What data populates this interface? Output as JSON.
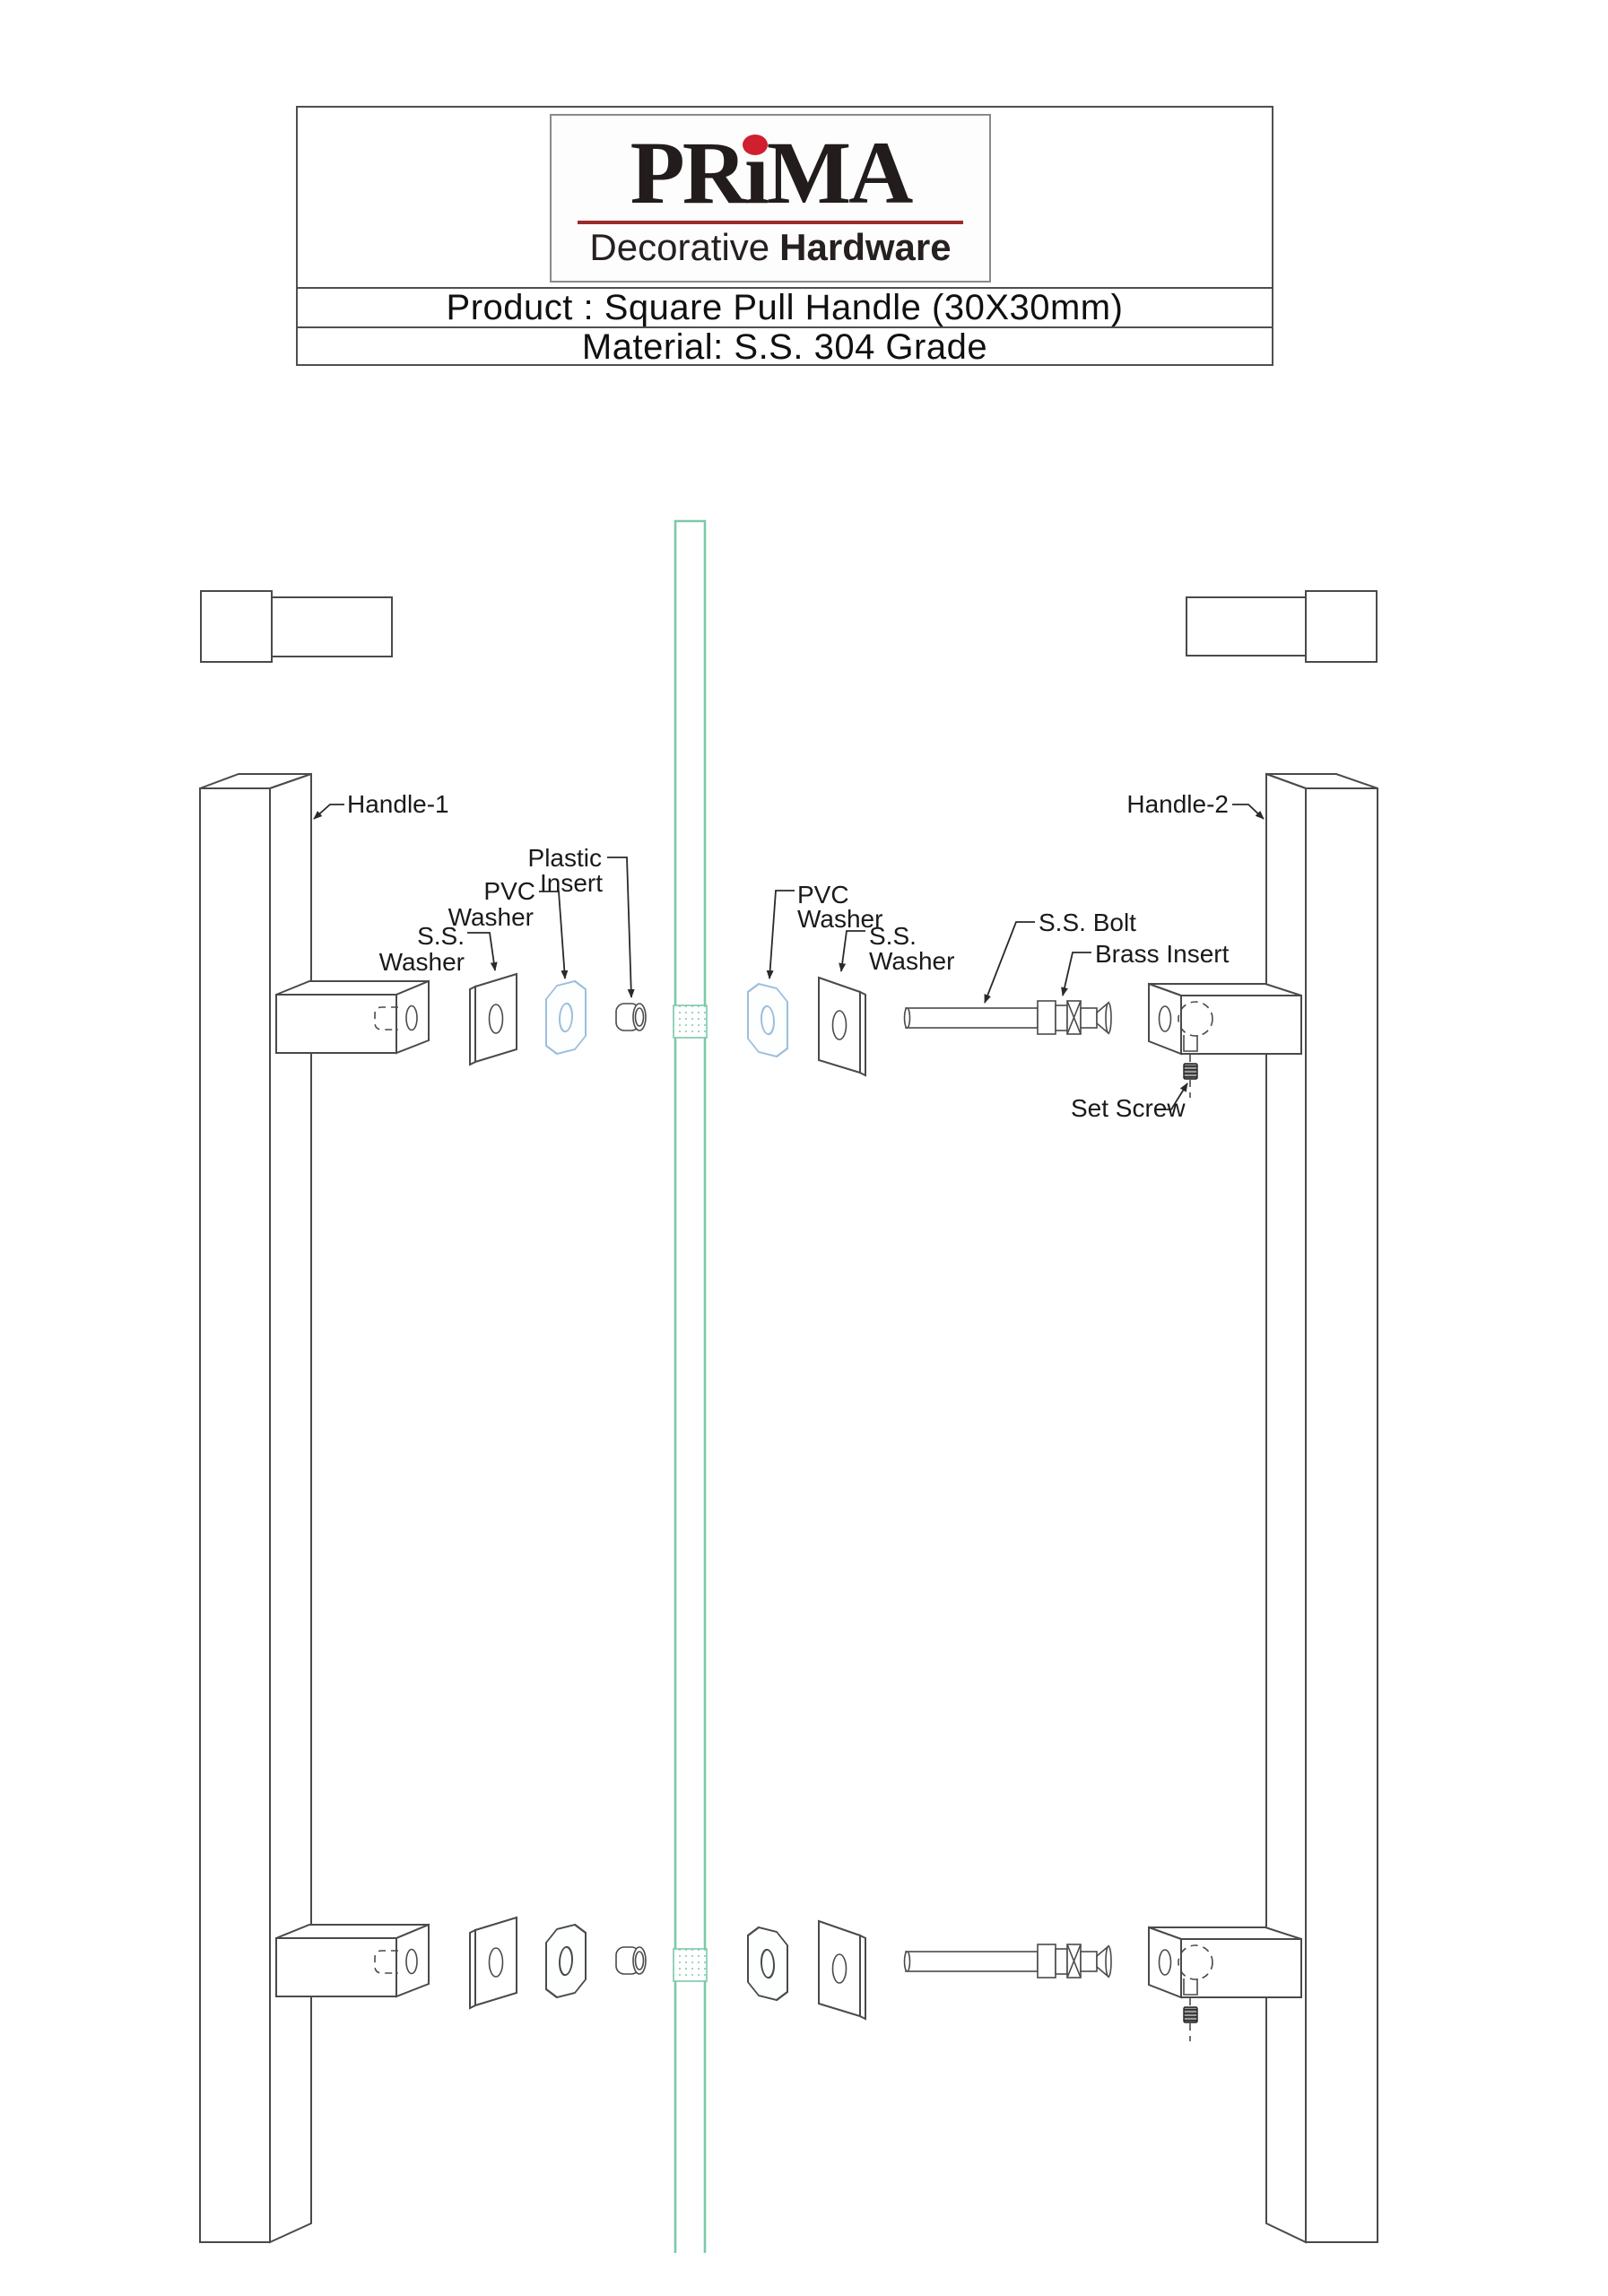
{
  "header": {
    "brand": {
      "pr": "PR",
      "i": "i",
      "ma": "MA",
      "tagline_regular": "Decorative",
      "tagline_bold": "Hardware"
    },
    "product_line": "Product : Square Pull Handle (30X30mm)",
    "material_line": "Material: S.S. 304 Grade"
  },
  "diagram": {
    "labels": {
      "handle_1": "Handle-1",
      "handle_2": "Handle-2",
      "ss_washer_l1": "S.S.",
      "ss_washer_l2": "Washer",
      "pvc_washer_l1": "PVC",
      "pvc_washer_l2": "Washer",
      "plastic_insert_l1": "Plastic",
      "plastic_insert_l2": "Insert",
      "ss_bolt": "S.S. Bolt",
      "brass_insert": "Brass Insert",
      "set_screw": "Set Screw"
    }
  },
  "colors": {
    "glass": "#7cc9a8",
    "pvc-washer": "#9cbfdd",
    "drawing-line": "#4a4a4a",
    "logo-red": "#d01f2f",
    "logo-underline": "#9d2b2b",
    "text-dark": "#1a1a1a"
  }
}
